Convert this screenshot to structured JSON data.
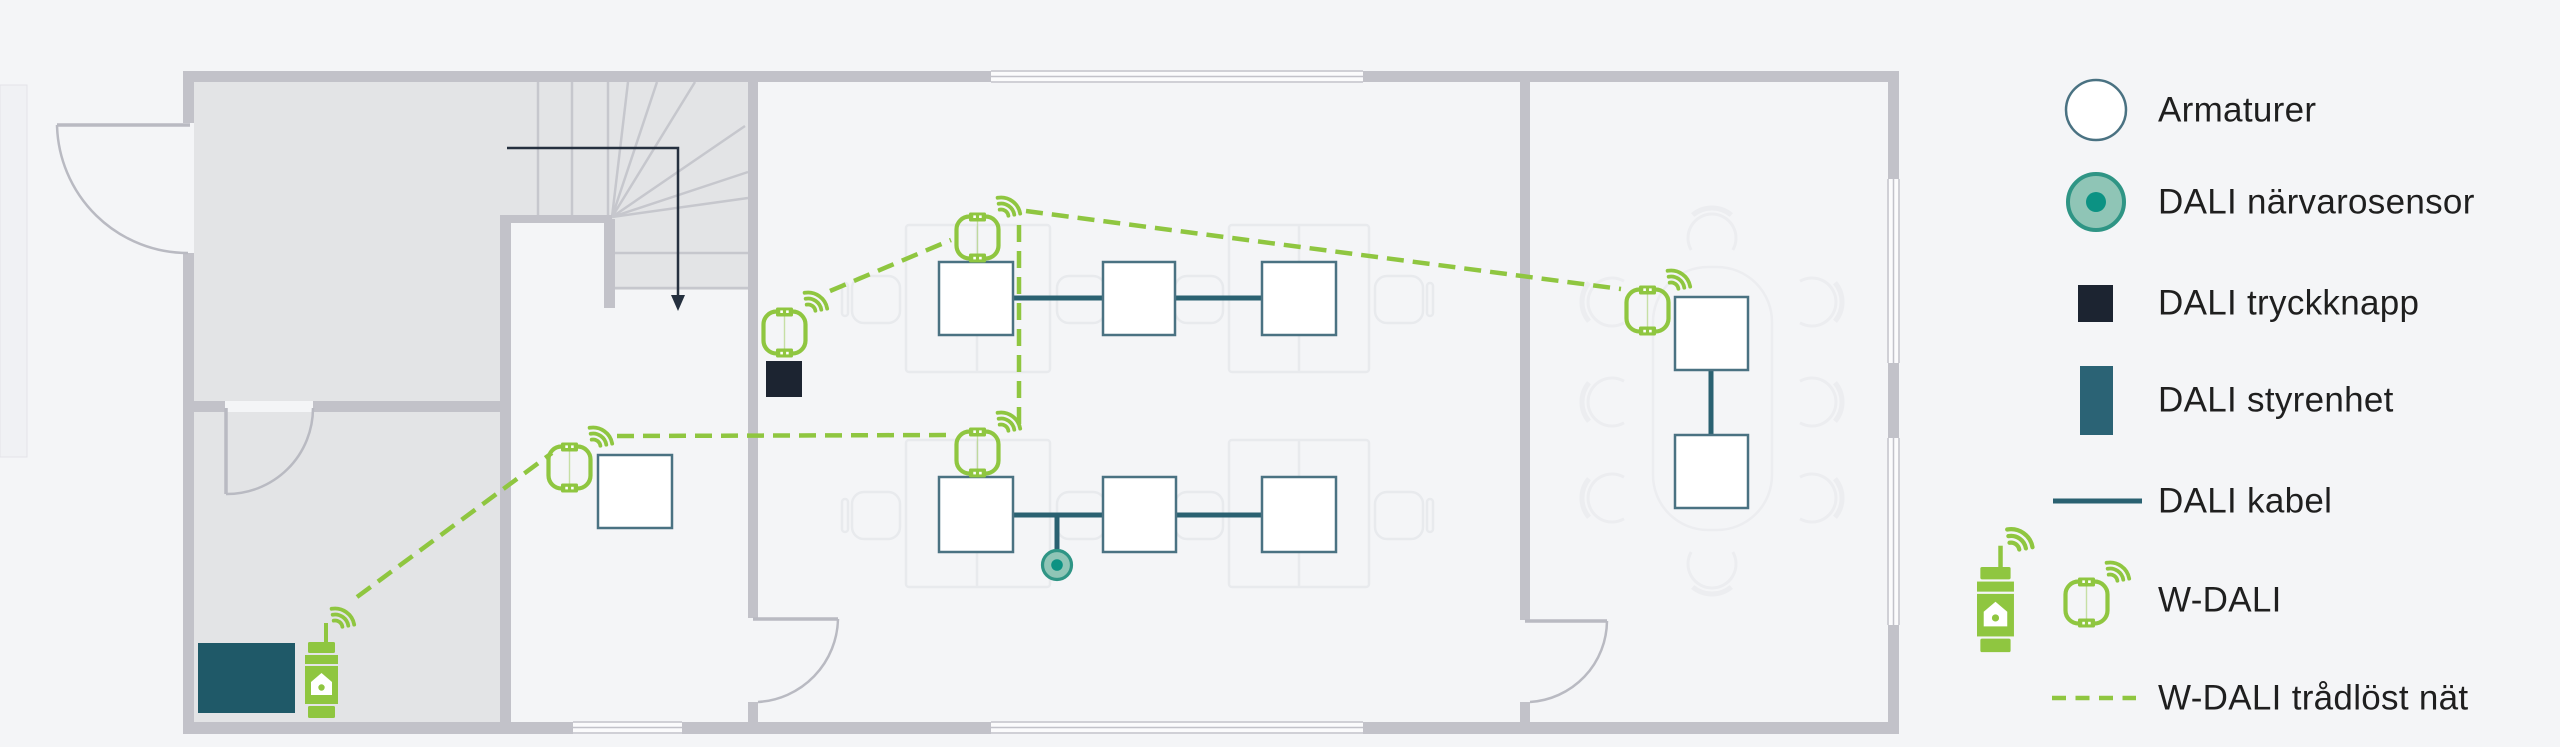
{
  "page": {
    "background": "#F4F5F7",
    "canvas": {
      "width": 2560,
      "height": 747
    },
    "kind": "DALI lighting system floor plan"
  },
  "colors": {
    "wall": "#C2C2C9",
    "room_fill": "#E3E4E6",
    "stair_line": "#C6C7CD",
    "accent_green": "#8FC640",
    "dali_cable_teal": "#2A6171",
    "armature_stroke": "#4A7282",
    "push_button_navy": "#1C2431",
    "control_unit_teal": "#1F5968",
    "legend_control_unit_teal": "#2B6375",
    "sensor_ring": "#2F9585",
    "sensor_fill": "#8FC5B6",
    "sensor_dot": "#0C9283",
    "furniture_outline": "#E8EAED",
    "door_line": "#B9BAC2",
    "text": "#1F1F1F"
  },
  "legend": {
    "items": [
      {
        "id": "armature",
        "icon": "armature-icon",
        "label": "Armaturer"
      },
      {
        "id": "presence-sensor",
        "icon": "presence-sensor-icon",
        "label": "DALI närvarosensor"
      },
      {
        "id": "push-button",
        "icon": "push-button-icon",
        "label": "DALI tryckknapp"
      },
      {
        "id": "control-unit",
        "icon": "control-unit-icon",
        "label": "DALI styrenhet"
      },
      {
        "id": "dali-cable",
        "icon": "dali-cable-icon",
        "label": "DALI kabel"
      },
      {
        "id": "w-dali",
        "icon": "w-dali-icon",
        "label": "W-DALI"
      },
      {
        "id": "wireless-network",
        "icon": "wireless-network-icon",
        "label": "W-DALI trådlöst nät"
      }
    ]
  },
  "plan": {
    "luminaires": 9,
    "presence_sensors": 1,
    "push_buttons": 1,
    "control_units": 1,
    "w_dali_modules": 5,
    "w_dali_gateways": 1,
    "wireless_links": 5
  }
}
